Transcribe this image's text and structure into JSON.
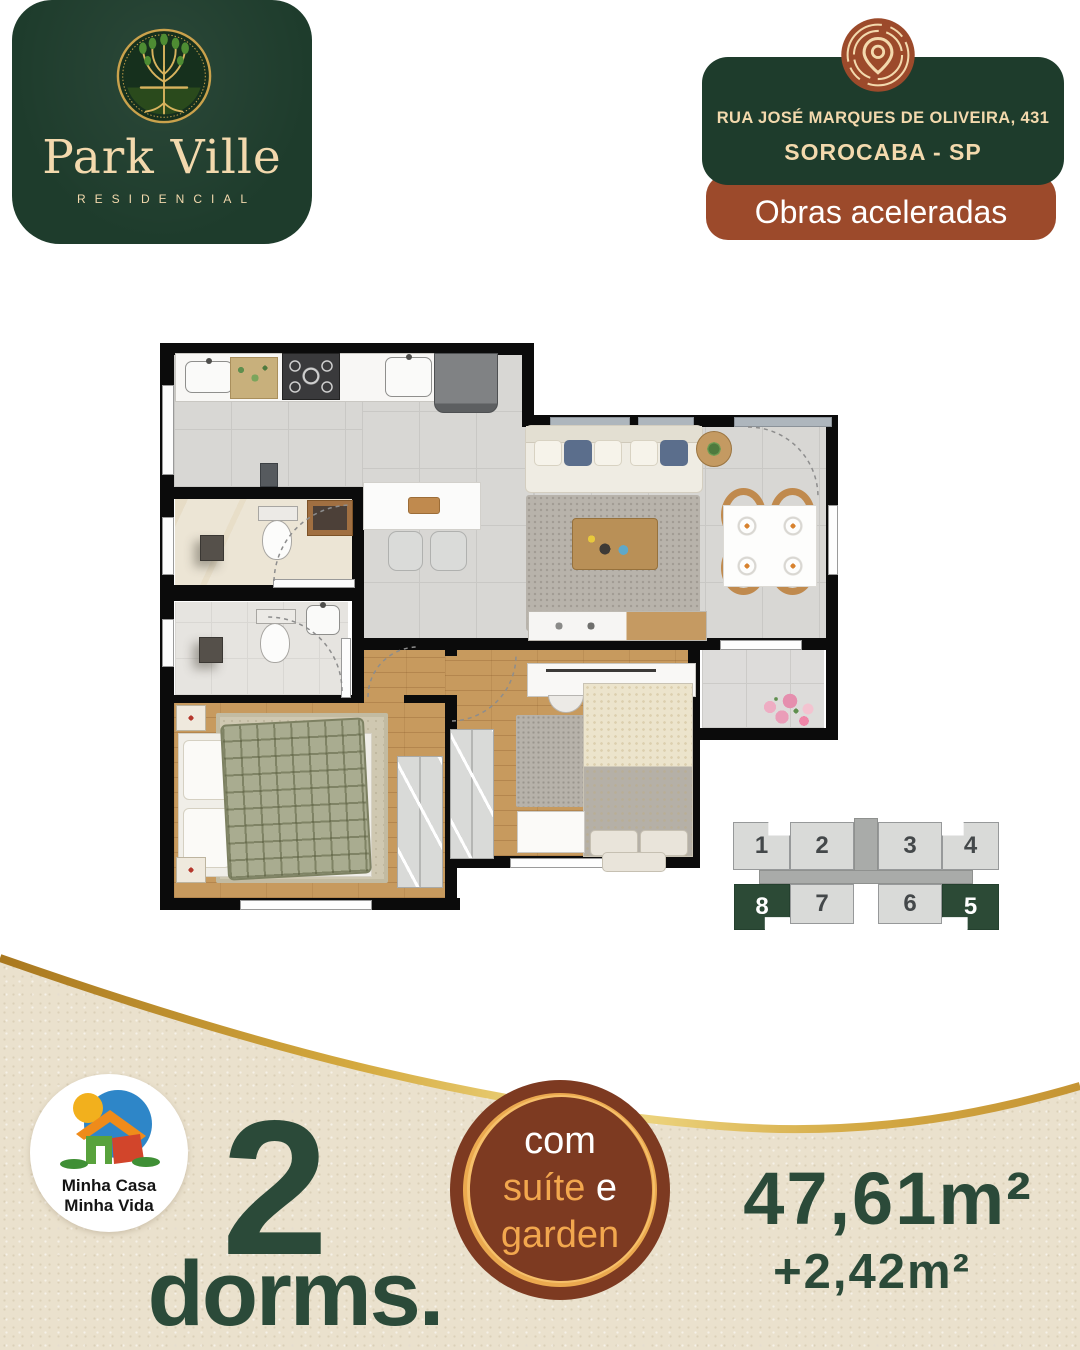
{
  "brand": {
    "name": "Park Ville",
    "subtitle": "RESIDENCIAL",
    "logo_icon": "tree-medallion-icon"
  },
  "location": {
    "address_line1": "RUA JOSÉ MARQUES DE OLIVEIRA, 431",
    "address_line2": "SOROCABA - SP",
    "status_banner": "Obras aceleradas",
    "icon": "map-pin-icon"
  },
  "keyplan": {
    "units_top": [
      "1",
      "2",
      "3",
      "4"
    ],
    "units_bottom": [
      "8",
      "7",
      "6",
      "5"
    ],
    "highlighted_units": [
      "8",
      "5"
    ],
    "highlight_color": "#2c4a36"
  },
  "program_logo": {
    "line1": "Minha Casa",
    "line2": "Minha Vida",
    "icon": "mcmv-house-icon"
  },
  "offer": {
    "dorms_value": "2",
    "dorms_label": "dorms.",
    "badge_word1": "com",
    "badge_word2": "suíte",
    "badge_word3": "e",
    "badge_word4": "garden",
    "area_private": "47,61m²",
    "area_garden": "+2,42m²"
  },
  "colors": {
    "brand_green": "#1e3c2c",
    "brand_brown": "#9c4a2b",
    "badge_brown": "#7d3a21",
    "cream": "#f3d9ad",
    "gold": "#d8ab46",
    "deep_green_text": "#2b4a39",
    "beige_band": "#eae1cd"
  }
}
